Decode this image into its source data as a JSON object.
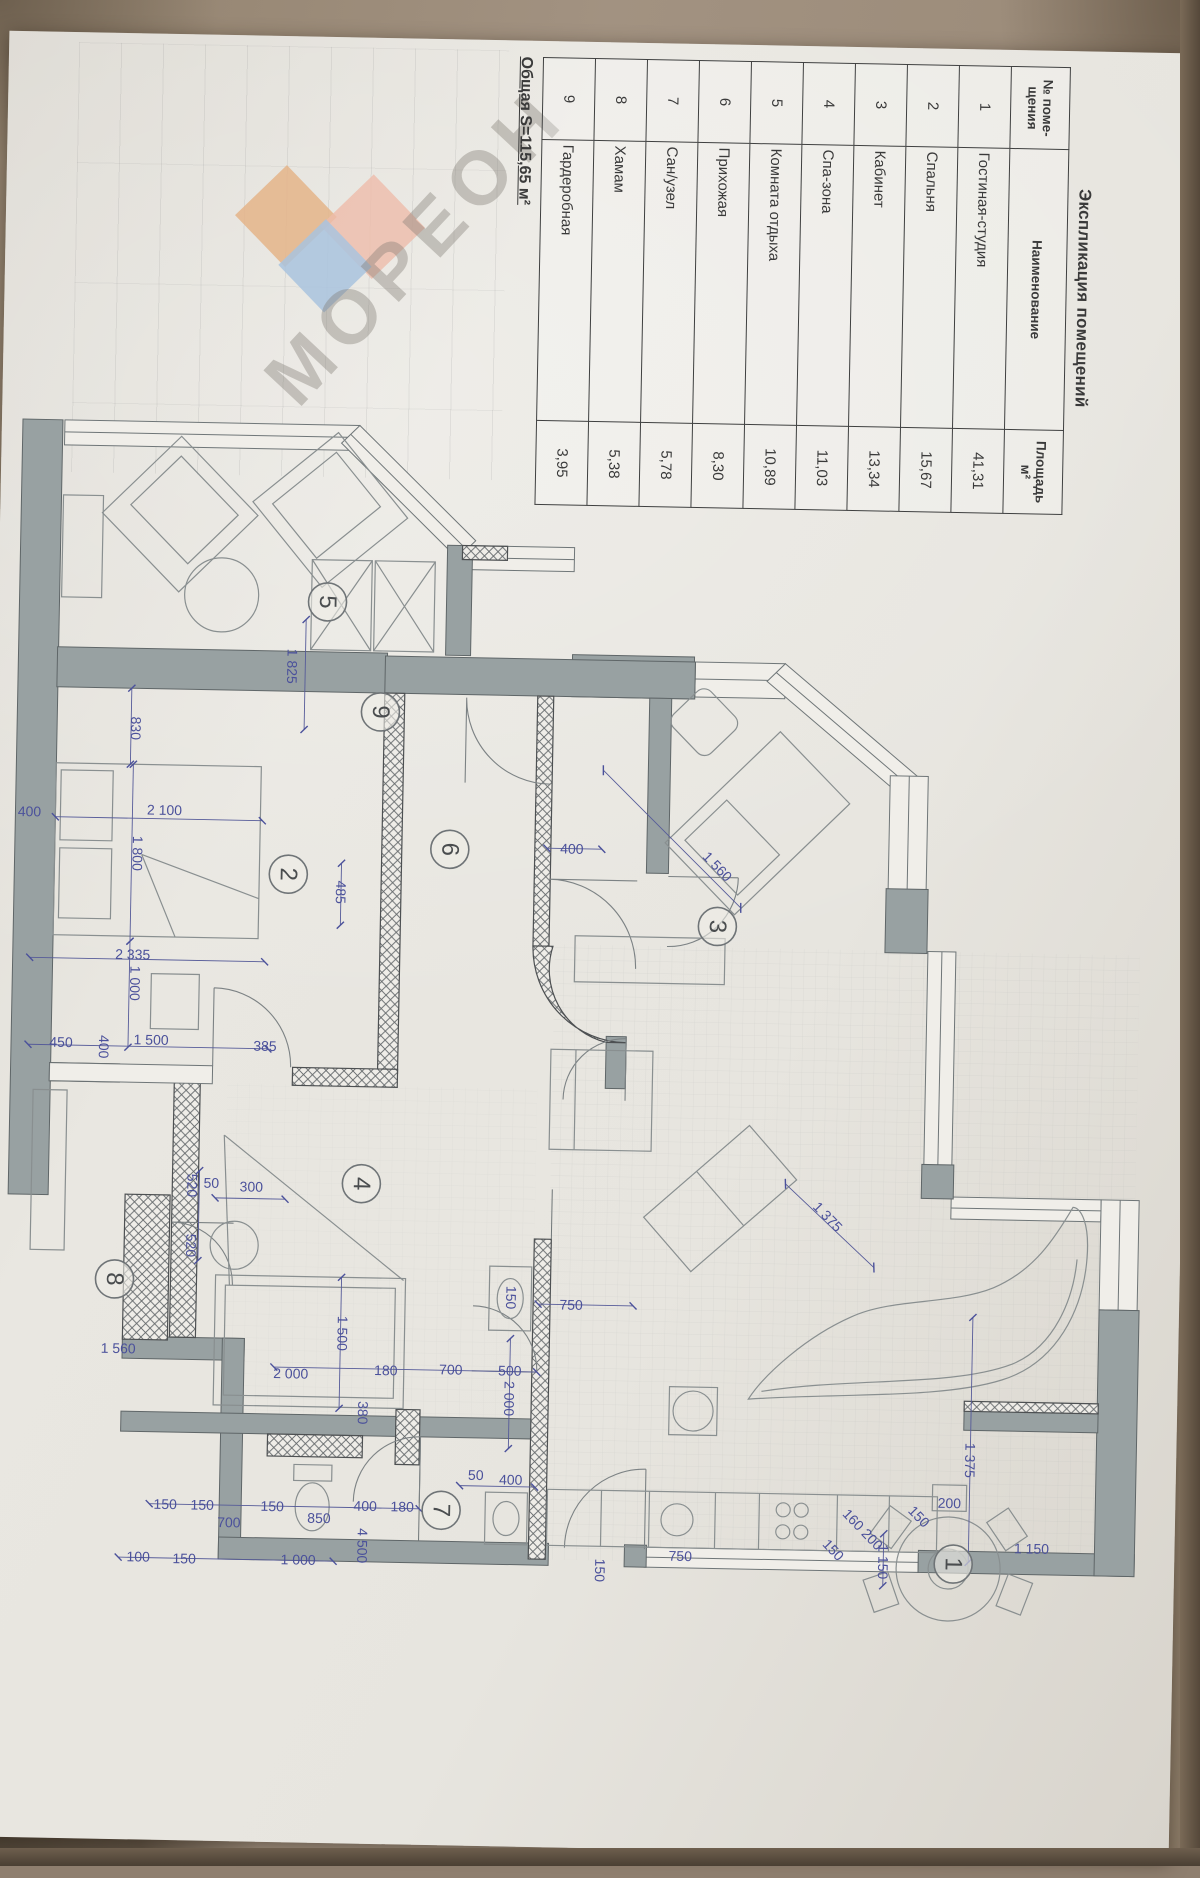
{
  "explication": {
    "title": "Экспликация помещений",
    "col_num": "№ поме- щения",
    "col_name": "Наименование",
    "col_area": "Площадь м²",
    "rows": [
      {
        "n": "1",
        "name": "Гостиная-студия",
        "area": "41,31"
      },
      {
        "n": "2",
        "name": "Спальня",
        "area": "15,67"
      },
      {
        "n": "3",
        "name": "Кабинет",
        "area": "13,34"
      },
      {
        "n": "4",
        "name": "Спа-зона",
        "area": "11,03"
      },
      {
        "n": "5",
        "name": "Комната отдыха",
        "area": "10,89"
      },
      {
        "n": "6",
        "name": "Прихожая",
        "area": "8,30"
      },
      {
        "n": "7",
        "name": "Сан/узел",
        "area": "5,78"
      },
      {
        "n": "8",
        "name": "Хамам",
        "area": "5,38"
      },
      {
        "n": "9",
        "name": "Гардеробная",
        "area": "3,95"
      }
    ],
    "total": "Общая S=115,65 м²"
  },
  "watermark": {
    "text": "МОРЕОН",
    "colors": {
      "orange": "#e4b488",
      "blue": "#a9c3de",
      "pink": "#eebbaa"
    }
  },
  "plan": {
    "wall_color": "#98a1a2",
    "dim_color": "#4b519b",
    "line_color": "#6f7678",
    "room_labels": [
      {
        "n": "1",
        "x": 965,
        "y": 1557
      },
      {
        "n": "2",
        "x": 287,
        "y": 880
      },
      {
        "n": "3",
        "x": 717,
        "y": 924
      },
      {
        "n": "4",
        "x": 366,
        "y": 1188
      },
      {
        "n": "5",
        "x": 321,
        "y": 607
      },
      {
        "n": "6",
        "x": 448,
        "y": 852
      },
      {
        "n": "7",
        "x": 452,
        "y": 1513
      },
      {
        "n": "8",
        "x": 121,
        "y": 1288
      },
      {
        "n": "9",
        "x": 376,
        "y": 716
      }
    ],
    "dimensions": [
      {
        "t": "830",
        "x": 132,
        "y": 737,
        "r": 90
      },
      {
        "t": "400",
        "x": 27,
        "y": 822,
        "r": 0
      },
      {
        "t": "2 100",
        "x": 162,
        "y": 818,
        "r": 0
      },
      {
        "t": "1 800",
        "x": 136,
        "y": 862,
        "r": 90
      },
      {
        "t": "1 000",
        "x": 136,
        "y": 992,
        "r": 90
      },
      {
        "t": "2 335",
        "x": 133,
        "y": 963,
        "r": 0
      },
      {
        "t": "450",
        "x": 63,
        "y": 1052,
        "r": 0
      },
      {
        "t": "400",
        "x": 106,
        "y": 1056,
        "r": 90
      },
      {
        "t": "1 500",
        "x": 153,
        "y": 1048,
        "r": 0
      },
      {
        "t": "385",
        "x": 267,
        "y": 1052,
        "r": 0
      },
      {
        "t": "1 825",
        "x": 287,
        "y": 672,
        "r": 90
      },
      {
        "t": "485",
        "x": 340,
        "y": 897,
        "r": 90
      },
      {
        "t": "400",
        "x": 570,
        "y": 849,
        "r": 0
      },
      {
        "t": "1 560",
        "x": 716,
        "y": 864,
        "r": 45
      },
      {
        "t": "1 560",
        "x": 126,
        "y": 1357,
        "r": 0
      },
      {
        "t": "520",
        "x": 197,
        "y": 1193,
        "r": 90
      },
      {
        "t": "520",
        "x": 197,
        "y": 1253,
        "r": 90
      },
      {
        "t": "50",
        "x": 216,
        "y": 1190,
        "r": 0
      },
      {
        "t": "300",
        "x": 256,
        "y": 1193,
        "r": 0
      },
      {
        "t": "1 500",
        "x": 350,
        "y": 1338,
        "r": 90
      },
      {
        "t": "2 000",
        "x": 299,
        "y": 1379,
        "r": 0
      },
      {
        "t": "180",
        "x": 394,
        "y": 1374,
        "r": 0
      },
      {
        "t": "700",
        "x": 459,
        "y": 1372,
        "r": 0
      },
      {
        "t": "500",
        "x": 518,
        "y": 1372,
        "r": 0
      },
      {
        "t": "380",
        "x": 372,
        "y": 1417,
        "r": 90
      },
      {
        "t": "50",
        "x": 486,
        "y": 1477,
        "r": 0
      },
      {
        "t": "400",
        "x": 521,
        "y": 1481,
        "r": 0
      },
      {
        "t": "150",
        "x": 176,
        "y": 1512,
        "r": 0
      },
      {
        "t": "150",
        "x": 213,
        "y": 1512,
        "r": 0
      },
      {
        "t": "700",
        "x": 240,
        "y": 1529,
        "r": 0
      },
      {
        "t": "150",
        "x": 283,
        "y": 1512,
        "r": 0
      },
      {
        "t": "850",
        "x": 330,
        "y": 1523,
        "r": 0
      },
      {
        "t": "400",
        "x": 376,
        "y": 1510,
        "r": 0
      },
      {
        "t": "180",
        "x": 413,
        "y": 1510,
        "r": 0
      },
      {
        "t": "100",
        "x": 150,
        "y": 1565,
        "r": 0
      },
      {
        "t": "150",
        "x": 196,
        "y": 1566,
        "r": 0
      },
      {
        "t": "1 000",
        "x": 310,
        "y": 1565,
        "r": 0
      },
      {
        "t": "4 500",
        "x": 374,
        "y": 1550,
        "r": 90
      },
      {
        "t": "150",
        "x": 612,
        "y": 1570,
        "r": 90
      },
      {
        "t": "750",
        "x": 692,
        "y": 1554,
        "r": 0
      },
      {
        "t": "750",
        "x": 578,
        "y": 1305,
        "r": 0
      },
      {
        "t": "150",
        "x": 518,
        "y": 1299,
        "r": 90
      },
      {
        "t": "2 000",
        "x": 518,
        "y": 1400,
        "r": 90
      },
      {
        "t": "1 375",
        "x": 833,
        "y": 1212,
        "r": 45
      },
      {
        "t": "1 375",
        "x": 980,
        "y": 1453,
        "r": 90
      },
      {
        "t": "200",
        "x": 960,
        "y": 1496,
        "r": 0
      },
      {
        "t": "150",
        "x": 930,
        "y": 1510,
        "r": 45
      },
      {
        "t": "160 200",
        "x": 874,
        "y": 1524,
        "r": 45
      },
      {
        "t": "150",
        "x": 845,
        "y": 1545,
        "r": 45
      },
      {
        "t": "1 150",
        "x": 895,
        "y": 1556,
        "r": 90
      },
      {
        "t": "1 150",
        "x": 1043,
        "y": 1540,
        "r": 0
      }
    ]
  }
}
